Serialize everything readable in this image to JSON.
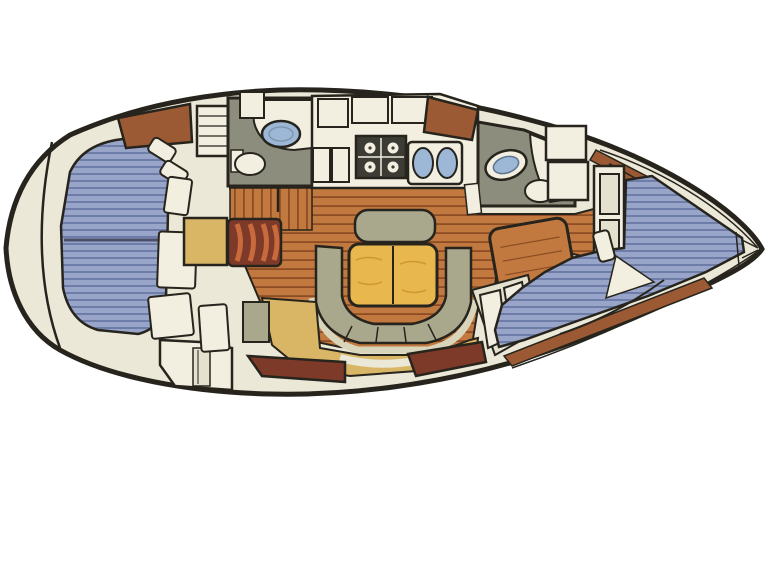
{
  "diagram": {
    "type": "boat-floor-plan",
    "orientation": "bow-right",
    "regions": {
      "stern": [
        "transom-bulkhead"
      ],
      "aft_cabin": [
        "double-berth",
        "pillows",
        "seat-cushions",
        "storage-cabinet",
        "hanging-locker",
        "dresser"
      ],
      "aft_head": [
        "sink",
        "toilet",
        "counter"
      ],
      "galley": [
        "stove",
        "double-sink",
        "overhead-lockers",
        "counter"
      ],
      "salon": [
        "u-settee",
        "folding-table",
        "backrest",
        "slatted-cabinet",
        "wood-floor",
        "hull-lockers"
      ],
      "nav_station": [
        "desk",
        "step-seat"
      ],
      "forward_head": [
        "sink",
        "toilet",
        "counter"
      ],
      "forward_cabin": [
        "v-berth",
        "shelf-unit",
        "lockers",
        "pillow"
      ],
      "bow": [
        "anchor-locker"
      ]
    }
  },
  "palette": {
    "background": "#ffffff",
    "outline": "#26241c",
    "hull_fill": "#ebe8d8",
    "cream": "#f2efe0",
    "cream_dim": "#e5e1cf",
    "wood_floor": "#c1793f",
    "wood_plank_line": "#8d4c24",
    "cabinet_brown": "#9c5a34",
    "locker_red": "#7e3a29",
    "slat_orange": "#c86a3c",
    "berth_blue": "#98a5c8",
    "berth_stripe": "#6e7da8",
    "berth_band": "#4a5068",
    "settee_olive": "#a9a78c",
    "settee_light": "#d9d5ba",
    "table_yellow": "#e8b84e",
    "table_grain": "#cf9733",
    "tan_floor": "#d9b566",
    "head_gray": "#8d8d7d",
    "sink_blue": "#9db7d6",
    "fixture_white": "#f2efe1",
    "stove_dark": "#3c3b34"
  }
}
